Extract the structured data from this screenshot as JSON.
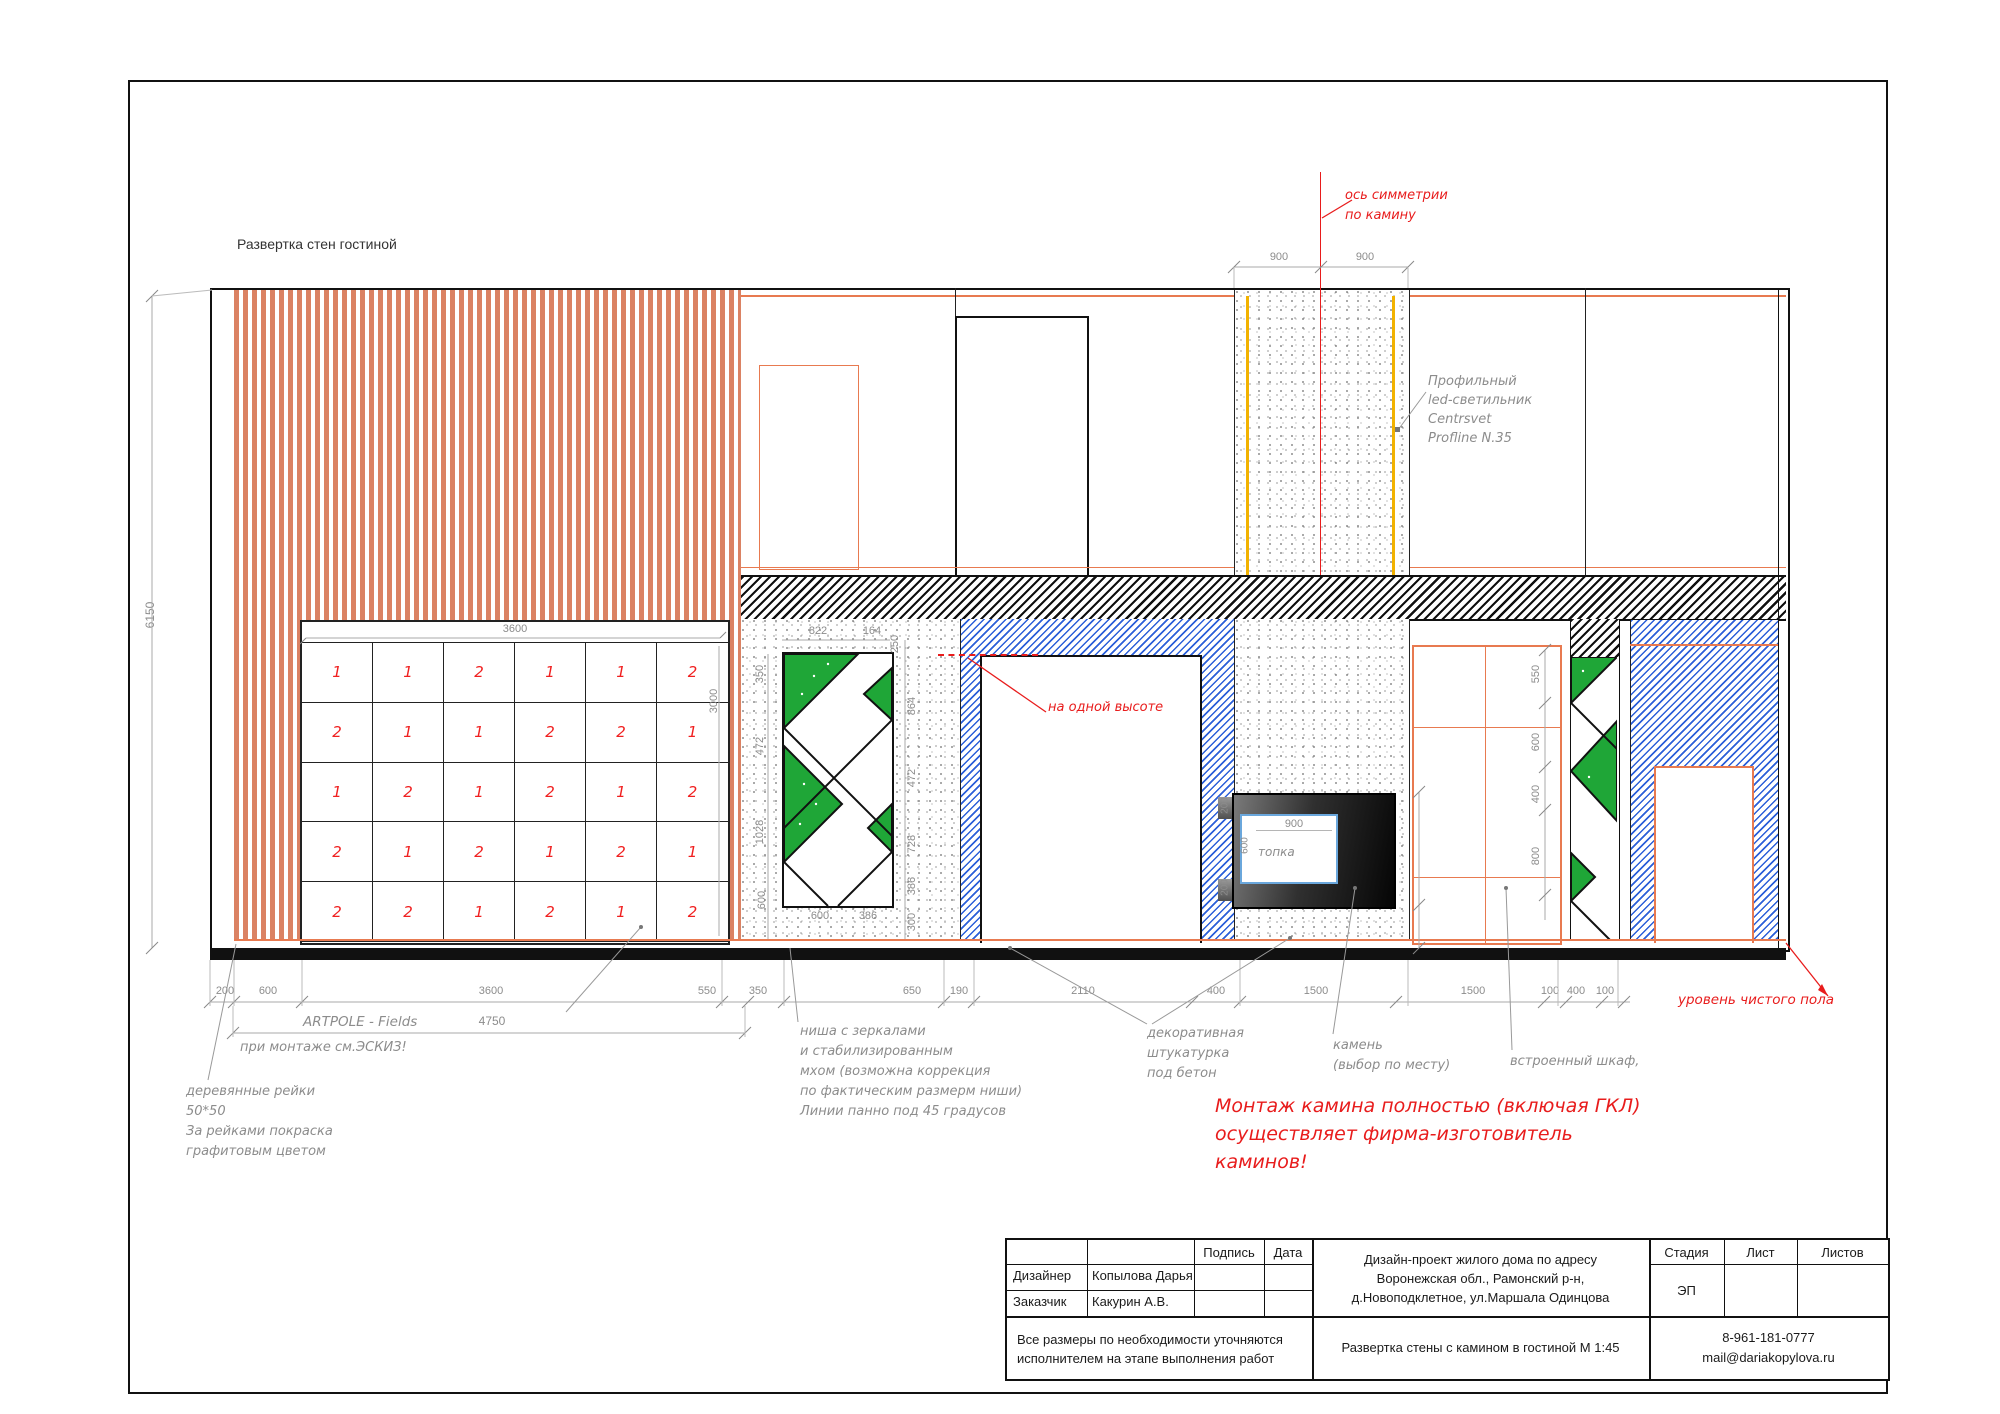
{
  "title": "Развертка стен гостиной",
  "colors": {
    "slat": "#DB8263",
    "accent_orange": "#E87A50",
    "annotation_red": "#E81C1C",
    "dim_gray": "#8C8C8C",
    "moss_green": "#1FA637",
    "hatch_blue": "#2B5FD9",
    "led_yellow": "#F2B200"
  },
  "left_dim": "6150",
  "slat_panel": {
    "top_dim": "3600",
    "right_dim": "3000",
    "rows": [
      [
        "1",
        "1",
        "2",
        "1",
        "1",
        "2"
      ],
      [
        "2",
        "1",
        "1",
        "2",
        "2",
        "1"
      ],
      [
        "1",
        "2",
        "1",
        "2",
        "1",
        "2"
      ],
      [
        "2",
        "1",
        "2",
        "1",
        "2",
        "1"
      ],
      [
        "2",
        "2",
        "1",
        "2",
        "1",
        "2"
      ]
    ]
  },
  "axis_label": {
    "line1": "ось симметрии",
    "line2": "по камину"
  },
  "dims_900": {
    "left": "900",
    "right": "900"
  },
  "led_label": {
    "l1": "Профильный",
    "l2": "led-светильник",
    "l3": "Centrsvet",
    "l4": "Profline N.35"
  },
  "same_height_label": "на одной высоте",
  "niche_dims": {
    "top1": "822",
    "top2": "164",
    "top3": "250",
    "left": [
      "350",
      "472",
      "1028",
      "600"
    ],
    "right": [
      "864",
      "472",
      "728",
      "386",
      "300"
    ],
    "bottom1": "600",
    "bottom2": "386"
  },
  "fireplace": {
    "width": "900",
    "firebox": "топка",
    "height": "600",
    "bar_top": "200",
    "bar_bottom": "200",
    "right1": "1000",
    "right2": "400"
  },
  "wardrobe_dims": [
    "550",
    "600",
    "400",
    "800"
  ],
  "bottom_dims": [
    "200",
    "600",
    "3600",
    "550",
    "350",
    "650",
    "190",
    "2110",
    "400",
    "1500",
    "1500",
    "100",
    "400",
    "100"
  ],
  "artpole": {
    "label": "ARTPOLE - Fields",
    "dim": "4750",
    "note": "при монтаже см.ЭСКИЗ!"
  },
  "floor_label": "уровень чистого пола",
  "notes": {
    "slats": [
      "деревянные рейки",
      "50*50",
      "За рейками покраска",
      "графитовым цветом"
    ],
    "niche": [
      "ниша с зеркалами",
      "и стабилизированным",
      "мхом (возможна коррекция",
      "по фактическим размерм ниши)",
      "Линии панно под 45 градусов"
    ],
    "plaster": [
      "декоративная",
      "штукатурка",
      "под бетон"
    ],
    "stone": [
      "камень",
      "(выбор по месту)"
    ],
    "cabinet": "встроенный шкаф,",
    "warning": [
      "Монтаж камина полностью (включая ГКЛ)",
      "осуществляет фирма-изготовитель",
      "каминов!"
    ]
  },
  "title_block": {
    "signature": "Подпись",
    "date": "Дата",
    "designer_label": "Дизайнер",
    "designer": "Копылова Дарья",
    "client_label": "Заказчик",
    "client": "Какурин А.В.",
    "disclaimer1": "Все размеры  по необходимости уточняются",
    "disclaimer2": "исполнителем на этапе выполнения работ",
    "project1": "Дизайн-проект жилого дома по адресу",
    "project2": "Воронежская обл., Рамонский р-н,",
    "project3": "д.Новоподклетное,  ул.Маршала Одинцова",
    "sheet_title": "Развертка стены с камином в гостиной М 1:45",
    "stage_label": "Стадия",
    "sheet_label": "Лист",
    "sheets_label": "Листов",
    "stage": "ЭП",
    "phone": "8-961-181-0777",
    "email": "mail@dariakopylova.ru"
  }
}
